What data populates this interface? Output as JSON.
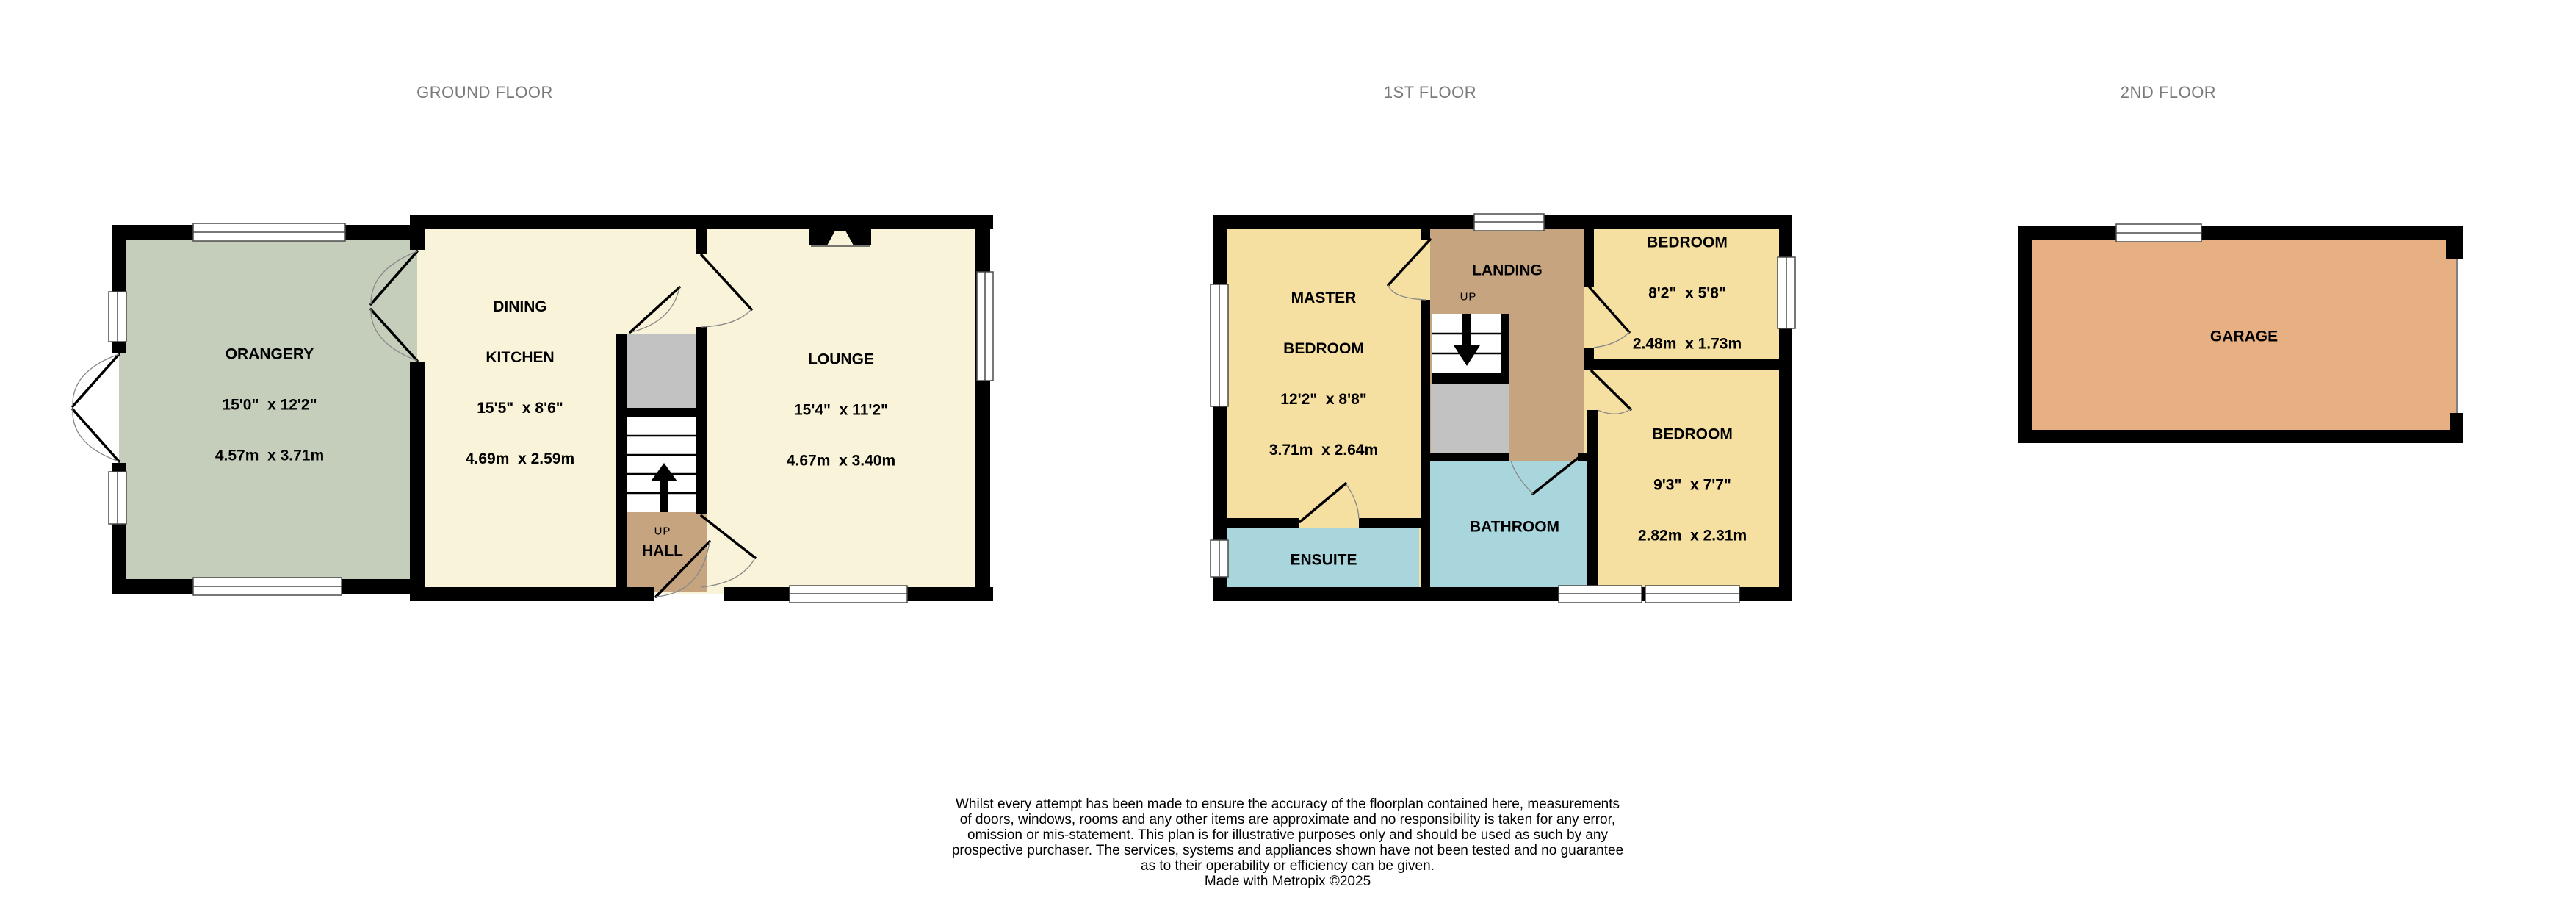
{
  "colors": {
    "wall": "#000000",
    "sage": "#c5cdbb",
    "cream": "#f9f4d9",
    "yellow": "#f5e0a1",
    "tan": "#c5a47f",
    "blue": "#a9d6dd",
    "gray_store": "#c2c2c2",
    "garage_orange": "#e7b083",
    "window_frame": "#4a4a4a",
    "door_arc": "#888888",
    "floor_label": "#7a7a7a",
    "garage_door_line": "#808080",
    "text": "#000000",
    "background": "#ffffff"
  },
  "floors": [
    {
      "label": "GROUND FLOOR",
      "stairs": {
        "up_label": "UP"
      },
      "rooms": [
        {
          "name": "ORANGERY",
          "imperial": "15'0\"  x 12'2\"",
          "metric": "4.57m  x 3.71m"
        },
        {
          "name_line1": "DINING",
          "name_line2": "KITCHEN",
          "imperial": "15'5\"  x 8'6\"",
          "metric": "4.69m  x 2.59m"
        },
        {
          "name": "LOUNGE",
          "imperial": "15'4\"  x 11'2\"",
          "metric": "4.67m  x 3.40m"
        },
        {
          "name": "HALL"
        }
      ]
    },
    {
      "label": "1ST FLOOR",
      "stairs": {
        "up_label": "UP"
      },
      "rooms": [
        {
          "name_line1": "MASTER",
          "name_line2": "BEDROOM",
          "imperial": "12'2\"  x 8'8\"",
          "metric": "3.71m  x 2.64m"
        },
        {
          "name": "LANDING"
        },
        {
          "name": "BEDROOM",
          "imperial": "8'2\"  x 5'8\"",
          "metric": "2.48m  x 1.73m"
        },
        {
          "name": "BEDROOM",
          "imperial": "9'3\"  x 7'7\"",
          "metric": "2.82m  x 2.31m"
        },
        {
          "name": "BATHROOM"
        },
        {
          "name": "ENSUITE"
        }
      ]
    },
    {
      "label": "2ND FLOOR",
      "rooms": [
        {
          "name": "GARAGE"
        }
      ]
    }
  ],
  "footer": {
    "lines": [
      "Whilst every attempt has been made to ensure the accuracy of the floorplan contained here, measurements",
      "of doors, windows, rooms and any other items are approximate and no responsibility is taken for any error,",
      "omission or mis-statement. This plan is for illustrative purposes only and should be used as such by any",
      "prospective purchaser. The services, systems and appliances shown have not been tested and no guarantee",
      "as to their operability or efficiency can be given.",
      "Made with Metropix ©2025"
    ]
  }
}
